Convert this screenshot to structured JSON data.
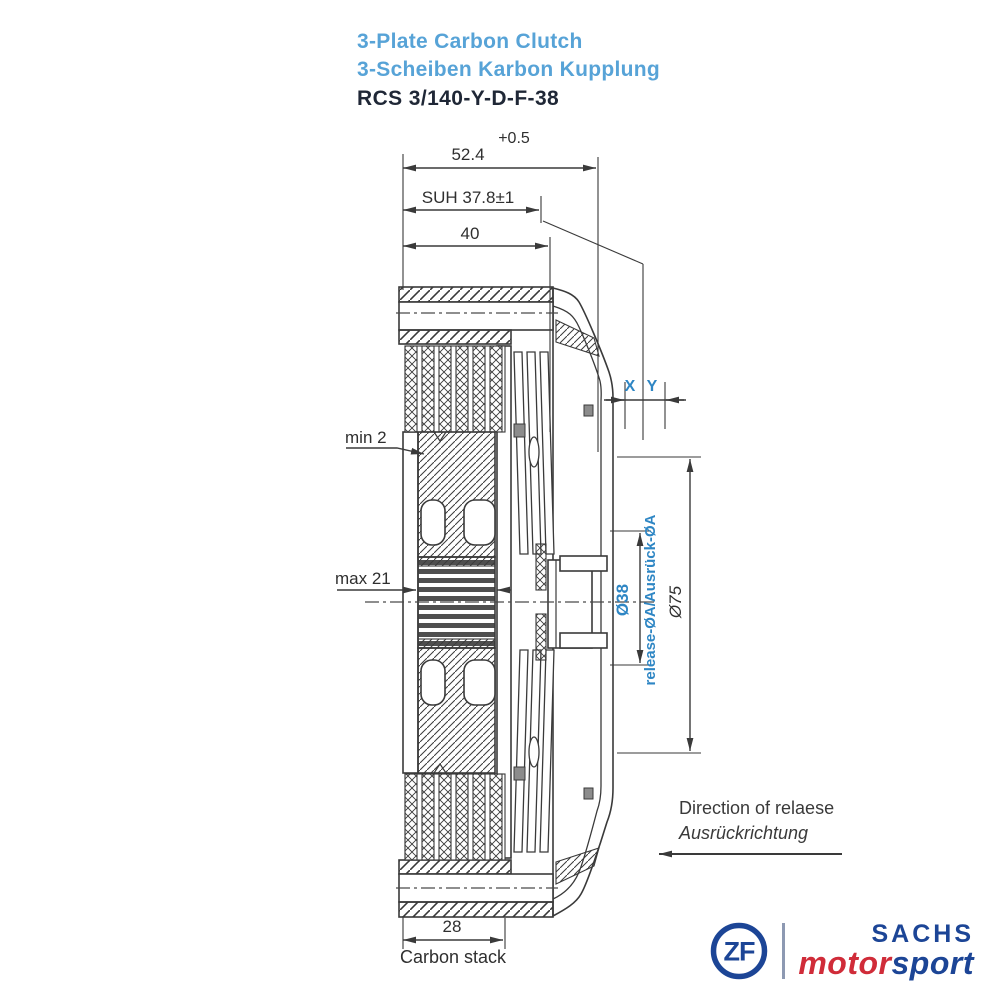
{
  "title": {
    "line1": "3-Plate Carbon Clutch",
    "line2": "3-Scheiben Karbon Kupplung",
    "part_number": "RCS 3/140-Y-D-F-38"
  },
  "dimensions": {
    "tolerance": "+0.5",
    "overall_width": "52.4",
    "suh": "SUH 37.8±1",
    "cover_width": "40",
    "min_wear": "min 2",
    "max_wear": "max 21",
    "x": "X",
    "y": "Y",
    "release_dia": "Ø38",
    "release_label": "release-ØA/Ausrück-ØA",
    "outer_dia": "Ø75",
    "stack_width": "28",
    "stack_label": "Carbon stack"
  },
  "direction": {
    "en": "Direction of relaese",
    "de": "Ausrückrichtung"
  },
  "logo": {
    "zf": "ZF",
    "sachs": "SACHS",
    "motor": "motor",
    "sport": "sport"
  },
  "colors": {
    "label_blue": "#2e86c4",
    "title_blue": "#57a3d7",
    "part_navy": "#1f2736",
    "zf_blue": "#1c4596",
    "motorsport_red": "#d02c39",
    "line": "#3a3a3a"
  }
}
